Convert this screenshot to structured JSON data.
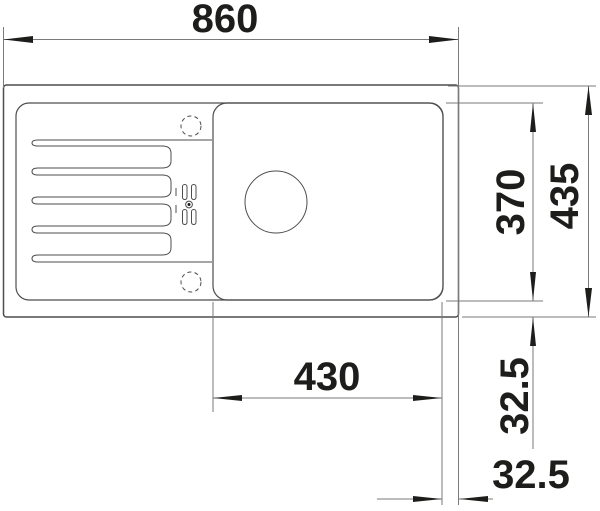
{
  "drawing": {
    "type": "sink-installation-plan-view",
    "labels": {
      "overall_width": "860",
      "overall_depth": "435",
      "bowl_depth": "370",
      "bowl_width": "430",
      "bowl_offset_vertical": "32.5",
      "bowl_offset_horizontal": "32.5"
    },
    "values": {
      "overall_width": 860,
      "overall_depth": 435,
      "bowl_depth": 370,
      "bowl_width": 430,
      "bowl_offset_vertical": 32.5,
      "bowl_offset_horizontal": 32.5
    }
  },
  "colors": {
    "background": "#ffffff",
    "outline": "#4d4d4d",
    "dimension_line": "#7a7a7a",
    "ink": "#1d1d1b"
  }
}
